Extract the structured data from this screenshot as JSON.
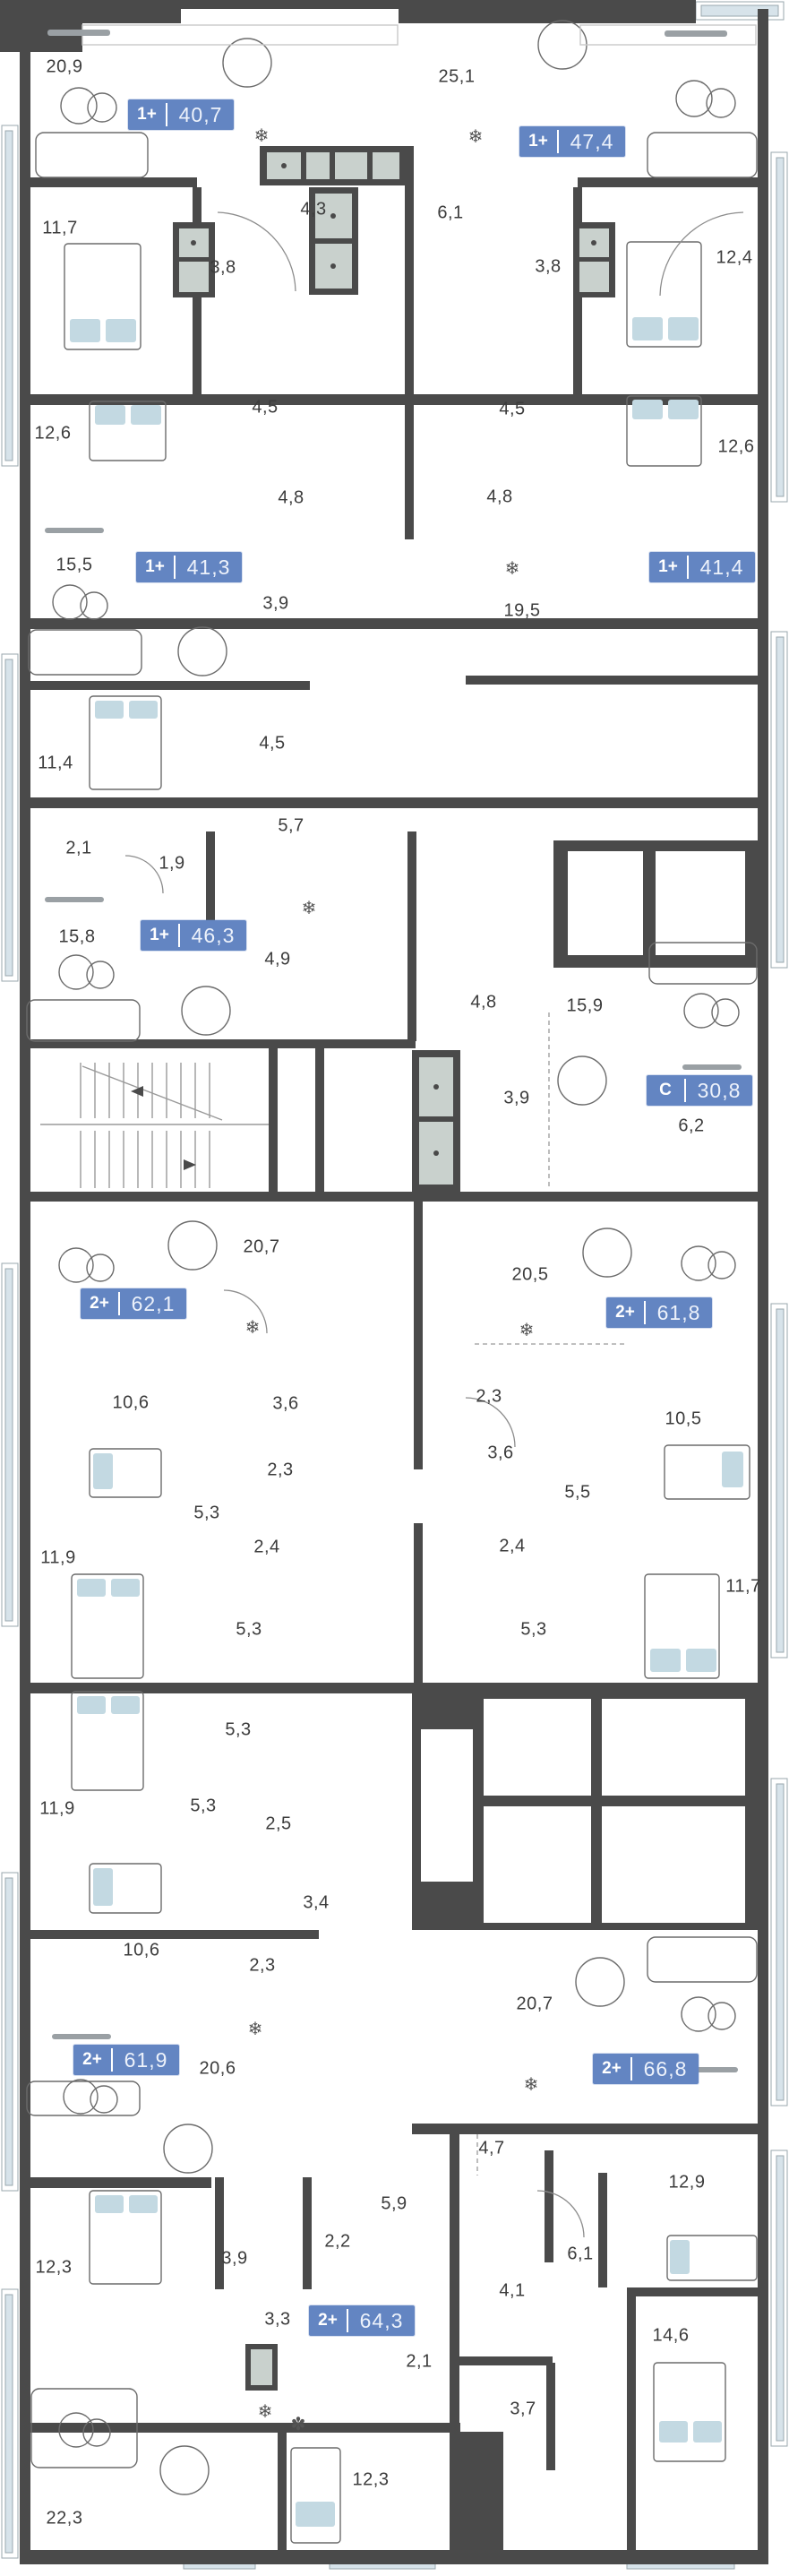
{
  "plan": {
    "name": "Этажный план / floor plan",
    "colors": {
      "wall": "#4a4a4a",
      "badge_blue": "#6385c2",
      "glass": "#d7e3ea",
      "label_gray": "#3c3c3c"
    }
  },
  "icons": {
    "snowflake": "❄",
    "fan": "✽"
  },
  "apartments": [
    {
      "type": "1+",
      "area": "40,7"
    },
    {
      "type": "1+",
      "area": "47,4"
    },
    {
      "type": "1+",
      "area": "41,3"
    },
    {
      "type": "1+",
      "area": "41,4"
    },
    {
      "type": "1+",
      "area": "46,3"
    },
    {
      "type": "С",
      "area": "30,8"
    },
    {
      "type": "2+",
      "area": "62,1"
    },
    {
      "type": "2+",
      "area": "61,8"
    },
    {
      "type": "2+",
      "area": "61,9"
    },
    {
      "type": "2+",
      "area": "66,8"
    },
    {
      "type": "2+",
      "area": "64,3"
    }
  ],
  "rooms": [
    "20,9",
    "25,1",
    "11,7",
    "4,3",
    "6,1",
    "3,8",
    "3,8",
    "12,4",
    "12,6",
    "4,5",
    "4,5",
    "12,6",
    "4,8",
    "4,8",
    "15,5",
    "3,9",
    "19,5",
    "11,4",
    "4,5",
    "5,7",
    "2,1",
    "1,9",
    "15,8",
    "4,9",
    "4,8",
    "15,9",
    "3,9",
    "6,2",
    "20,7",
    "20,5",
    "10,6",
    "3,6",
    "2,3",
    "2,3",
    "10,5",
    "3,6",
    "5,3",
    "5,5",
    "2,4",
    "2,4",
    "11,9",
    "5,3",
    "5,3",
    "11,7",
    "5,3",
    "11,9",
    "5,3",
    "2,5",
    "3,4",
    "10,6",
    "2,3",
    "20,6",
    "20,7",
    "12,3",
    "3,9",
    "2,2",
    "5,9",
    "3,3",
    "2,1",
    "12,3",
    "22,3",
    "4,7",
    "12,9",
    "6,1",
    "4,1",
    "3,7",
    "14,6"
  ]
}
